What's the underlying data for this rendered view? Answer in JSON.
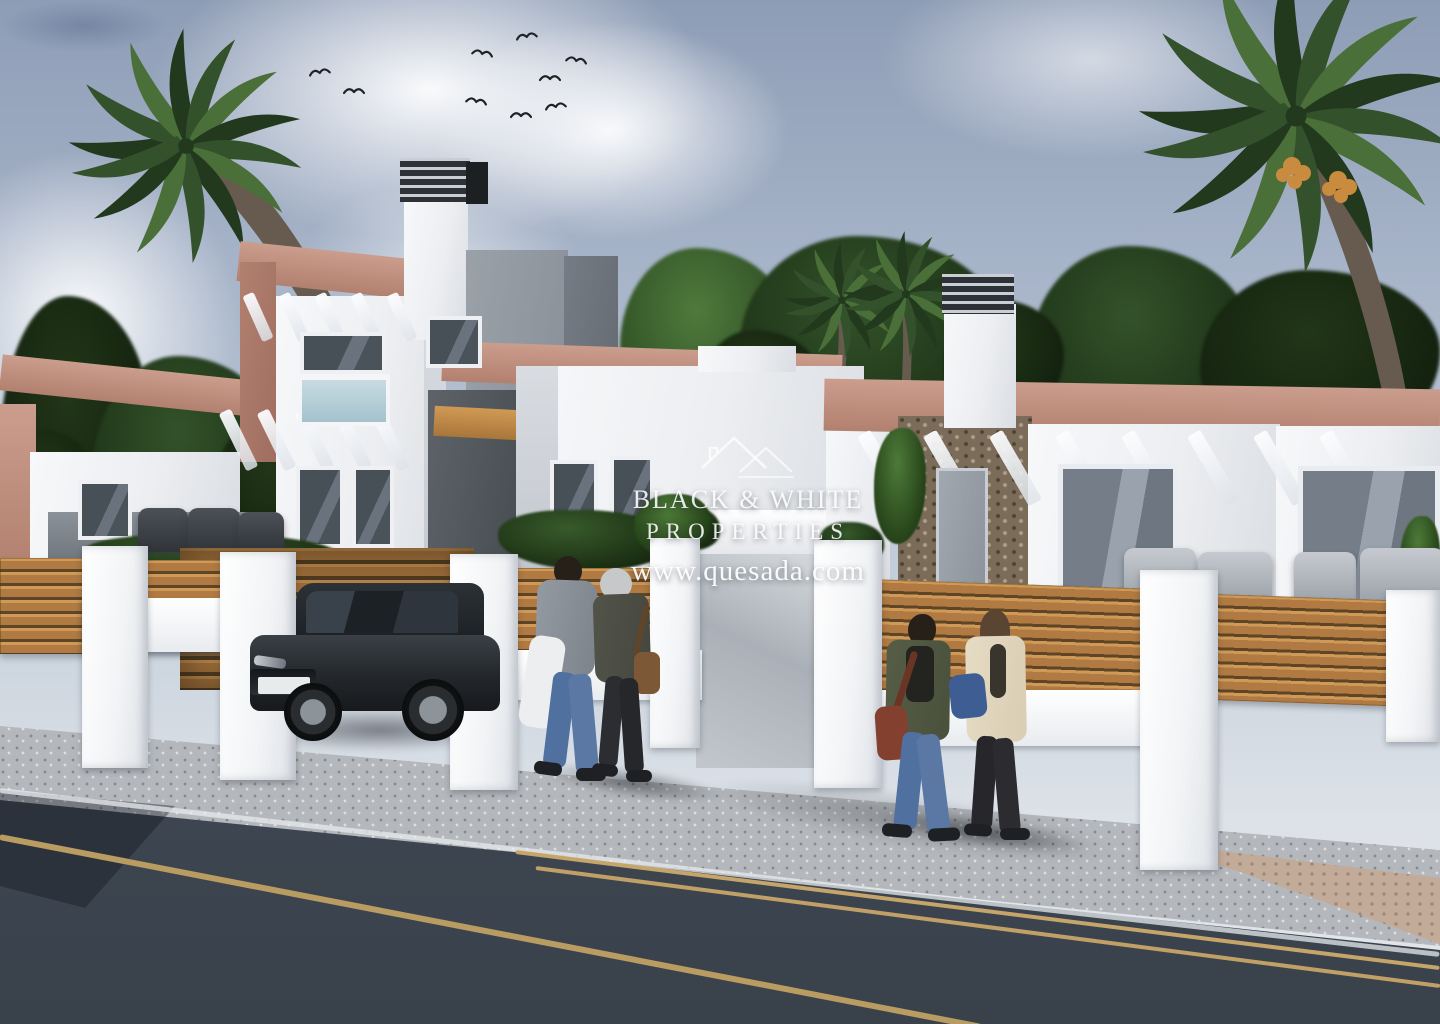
{
  "watermark": {
    "logo": "double-roof-outline-icon",
    "line1": "BLACK & WHITE",
    "line2": "PROPERTIES",
    "line3": "www.quesada.com"
  },
  "palette": {
    "sky_top": "#8e9db6",
    "sky_mid": "#aab7cb",
    "sky_low": "#c6d0db",
    "terracotta": "#cb9d8d",
    "terracotta_dark": "#b2806f",
    "louver_dark": "#2e3236",
    "louver_light": "#c9ced4",
    "wood": "#b07a42",
    "wood_light": "#cf9a58",
    "wood_gap": "#5e4526",
    "stone_beige": "#c9bba4",
    "sidewalk": "#b4b7bb",
    "road_top": "#46505c",
    "road_bottom": "#39414b",
    "line_tan": "#c6a56b",
    "line_white": "#e8ebee",
    "palm_green": "#33522c",
    "palm_dark": "#22391d",
    "trunk": "#665b4e",
    "dates": "#c98b3e",
    "car_body": "#23272b",
    "hair_dark": "#262019",
    "sweater": "#949aa1",
    "white_jacket": "#eceef0",
    "jeans": "#50709f",
    "jeans2": "#5b77a4",
    "hood": "#c6c8ca",
    "coat_dark": "#45463e",
    "bag_brown": "#7c5836",
    "legs_dark": "#2c2d31",
    "shoe": "#1e2023",
    "olive": "#49503b",
    "tee": "#232420",
    "bag_red": "#83402e",
    "cardigan": "#d9cdb3",
    "hair_brown": "#5a4533",
    "pants_dark": "#26262b",
    "bag_blue": "#3e5e93"
  },
  "scene": {
    "birds": [
      [
        308,
        63
      ],
      [
        343,
        82
      ],
      [
        466,
        92
      ],
      [
        515,
        27
      ],
      [
        539,
        69
      ],
      [
        566,
        51
      ],
      [
        544,
        97
      ],
      [
        510,
        106
      ],
      [
        472,
        44
      ]
    ],
    "clouds": [
      [
        150,
        -60,
        560,
        300,
        0.95
      ],
      [
        430,
        20,
        360,
        220,
        0.9
      ],
      [
        -80,
        150,
        320,
        340,
        0.95
      ],
      [
        620,
        320,
        300,
        150,
        0.85
      ],
      [
        880,
        -40,
        420,
        200,
        0.6
      ],
      [
        1020,
        320,
        240,
        130,
        0.5
      ],
      [
        300,
        180,
        280,
        160,
        0.5
      ]
    ],
    "trees": [
      [
        0,
        296,
        150,
        280,
        "dark"
      ],
      [
        92,
        356,
        190,
        220,
        "mid"
      ],
      [
        212,
        416,
        130,
        150,
        "dark"
      ],
      [
        0,
        430,
        100,
        150,
        "dark"
      ],
      [
        620,
        248,
        170,
        180,
        "light"
      ],
      [
        740,
        236,
        260,
        200,
        "mid"
      ],
      [
        700,
        330,
        120,
        110,
        "dark"
      ],
      [
        1030,
        246,
        220,
        200,
        "mid"
      ],
      [
        1200,
        270,
        240,
        180,
        "dark"
      ],
      [
        944,
        300,
        120,
        120,
        "dark"
      ],
      [
        396,
        420,
        120,
        150,
        "dark"
      ]
    ],
    "palms": [
      {
        "cx": 186,
        "cy": 146,
        "s": 1.12,
        "trunk": "M180,152 C236,196 320,306 380,470 L402,466 C344,282 252,162 194,132 Z"
      },
      {
        "cx": 1296,
        "cy": 116,
        "s": 1.5,
        "trunk": "M1288,128 C1326,192 1370,312 1390,434 L1412,432 C1396,300 1342,168 1306,112 Z"
      },
      {
        "cx": 842,
        "cy": 300,
        "s": 0.55,
        "trunk": "M838,306 C840,334 838,364 834,396 L843,396 C847,362 848,332 847,302 Z"
      },
      {
        "cx": 906,
        "cy": 294,
        "s": 0.6,
        "trunk": "M902,300 C904,332 903,364 901,398 L910,398 C912,362 912,330 911,296 Z"
      }
    ],
    "dates": [
      [
        1292,
        166
      ],
      [
        1338,
        180
      ]
    ],
    "walls": [
      [
        0,
        372,
        340,
        36,
        "terra",
        6
      ],
      [
        0,
        404,
        36,
        166,
        "terra",
        0
      ],
      [
        30,
        452,
        210,
        118,
        "white",
        0
      ],
      [
        48,
        512,
        240,
        50,
        "furngray",
        0
      ],
      [
        238,
        252,
        210,
        40,
        "terra",
        6
      ],
      [
        240,
        262,
        36,
        200,
        "terra2",
        0
      ],
      [
        276,
        296,
        168,
        324,
        "white",
        0
      ],
      [
        424,
        296,
        22,
        324,
        "shade",
        0
      ],
      [
        404,
        194,
        64,
        146,
        "white",
        0
      ],
      [
        400,
        158,
        70,
        44,
        "louver",
        0
      ],
      [
        466,
        162,
        22,
        42,
        "black",
        0
      ],
      [
        466,
        250,
        102,
        316,
        "gray",
        0
      ],
      [
        564,
        256,
        54,
        310,
        "graydark",
        0
      ],
      [
        428,
        390,
        94,
        178,
        "darkwall",
        0
      ],
      [
        434,
        408,
        86,
        30,
        "woodbeam",
        3
      ],
      [
        442,
        348,
        400,
        40,
        "terra",
        2
      ],
      [
        516,
        366,
        348,
        204,
        "white",
        0
      ],
      [
        698,
        346,
        98,
        26,
        "white",
        0
      ],
      [
        516,
        366,
        42,
        204,
        "shade",
        0
      ],
      [
        650,
        510,
        218,
        48,
        "canopy",
        0
      ],
      [
        696,
        554,
        124,
        214,
        "recess",
        0
      ],
      [
        826,
        406,
        64,
        194,
        "white",
        0
      ],
      [
        824,
        384,
        616,
        52,
        "terra",
        1
      ],
      [
        898,
        416,
        134,
        188,
        "stonewall",
        0
      ],
      [
        1028,
        424,
        252,
        186,
        "white",
        0
      ],
      [
        944,
        304,
        72,
        124,
        "white",
        0
      ],
      [
        942,
        274,
        72,
        40,
        "louver",
        0
      ],
      [
        1276,
        426,
        164,
        190,
        "white",
        0
      ]
    ],
    "rafters": [
      [
        232,
        408,
        5,
        13,
        64,
        38,
        -26
      ],
      [
        252,
        292,
        5,
        12,
        50,
        36,
        -24
      ],
      [
        876,
        428,
        8,
        15,
        80,
        66,
        -30
      ]
    ],
    "windows": [
      [
        300,
        332,
        86,
        42,
        "dark"
      ],
      [
        298,
        374,
        92,
        52,
        "blue"
      ],
      [
        296,
        466,
        48,
        82,
        "dark"
      ],
      [
        352,
        466,
        42,
        82,
        "dark"
      ],
      [
        426,
        316,
        56,
        52,
        "dark"
      ],
      [
        78,
        480,
        54,
        60,
        "dark"
      ],
      [
        550,
        460,
        48,
        68,
        "dark"
      ],
      [
        610,
        456,
        44,
        68,
        "dark"
      ],
      [
        936,
        468,
        52,
        126,
        "door"
      ],
      [
        1058,
        464,
        120,
        138,
        "glass"
      ],
      [
        1298,
        466,
        142,
        150,
        "glass"
      ]
    ],
    "hedges": [
      [
        84,
        534,
        256,
        44
      ],
      [
        498,
        510,
        172,
        60
      ],
      [
        660,
        506,
        60,
        44
      ],
      [
        820,
        522,
        64,
        42
      ]
    ],
    "plants": [
      [
        634,
        494,
        76,
        62
      ],
      [
        874,
        428,
        52,
        116
      ],
      [
        1400,
        516,
        40,
        88
      ]
    ],
    "furniture": [
      [
        138,
        508,
        50,
        44,
        "d"
      ],
      [
        188,
        508,
        52,
        46,
        "d"
      ],
      [
        238,
        512,
        46,
        40,
        "d"
      ],
      [
        1124,
        548,
        72,
        64,
        "l"
      ],
      [
        1198,
        552,
        74,
        60,
        "l"
      ],
      [
        1294,
        552,
        62,
        62,
        "l"
      ],
      [
        1360,
        548,
        84,
        66,
        "l"
      ]
    ],
    "fences": {
      "garage": [
        [
          180,
          548,
          294,
          142
        ]
      ],
      "wood": [
        [
          0,
          558,
          96,
          96,
          0
        ],
        [
          146,
          560,
          94,
          92,
          0
        ],
        [
          502,
          568,
          162,
          100,
          0
        ],
        [
          874,
          584,
          274,
          120,
          2
        ],
        [
          1212,
          598,
          230,
          106,
          2
        ]
      ],
      "bars": [
        [
          82,
          598,
          214,
          54
        ],
        [
          450,
          650,
          252,
          50
        ],
        [
          874,
          690,
          276,
          56
        ]
      ],
      "pillars": [
        [
          82,
          546,
          66,
          222
        ],
        [
          220,
          552,
          76,
          228
        ],
        [
          450,
          554,
          68,
          236
        ],
        [
          650,
          538,
          50,
          210
        ],
        [
          814,
          540,
          68,
          248
        ],
        [
          1140,
          570,
          78,
          300
        ],
        [
          1386,
          590,
          54,
          152
        ]
      ],
      "bases": [
        [
          0,
          642,
          82,
          130
        ],
        [
          150,
          648,
          70,
          124
        ],
        [
          1216,
          688,
          224,
          112
        ]
      ]
    },
    "road_lines": [
      [
        0,
        788,
        1440,
        952,
        5,
        "rgba(232,235,238,.75)"
      ],
      [
        516,
        850,
        1440,
        966,
        4,
        "#c6a56b"
      ],
      [
        536,
        866,
        1440,
        984,
        4,
        "#c0a066"
      ],
      [
        0,
        834,
        982,
        1024,
        6,
        "#b89c62"
      ]
    ]
  }
}
